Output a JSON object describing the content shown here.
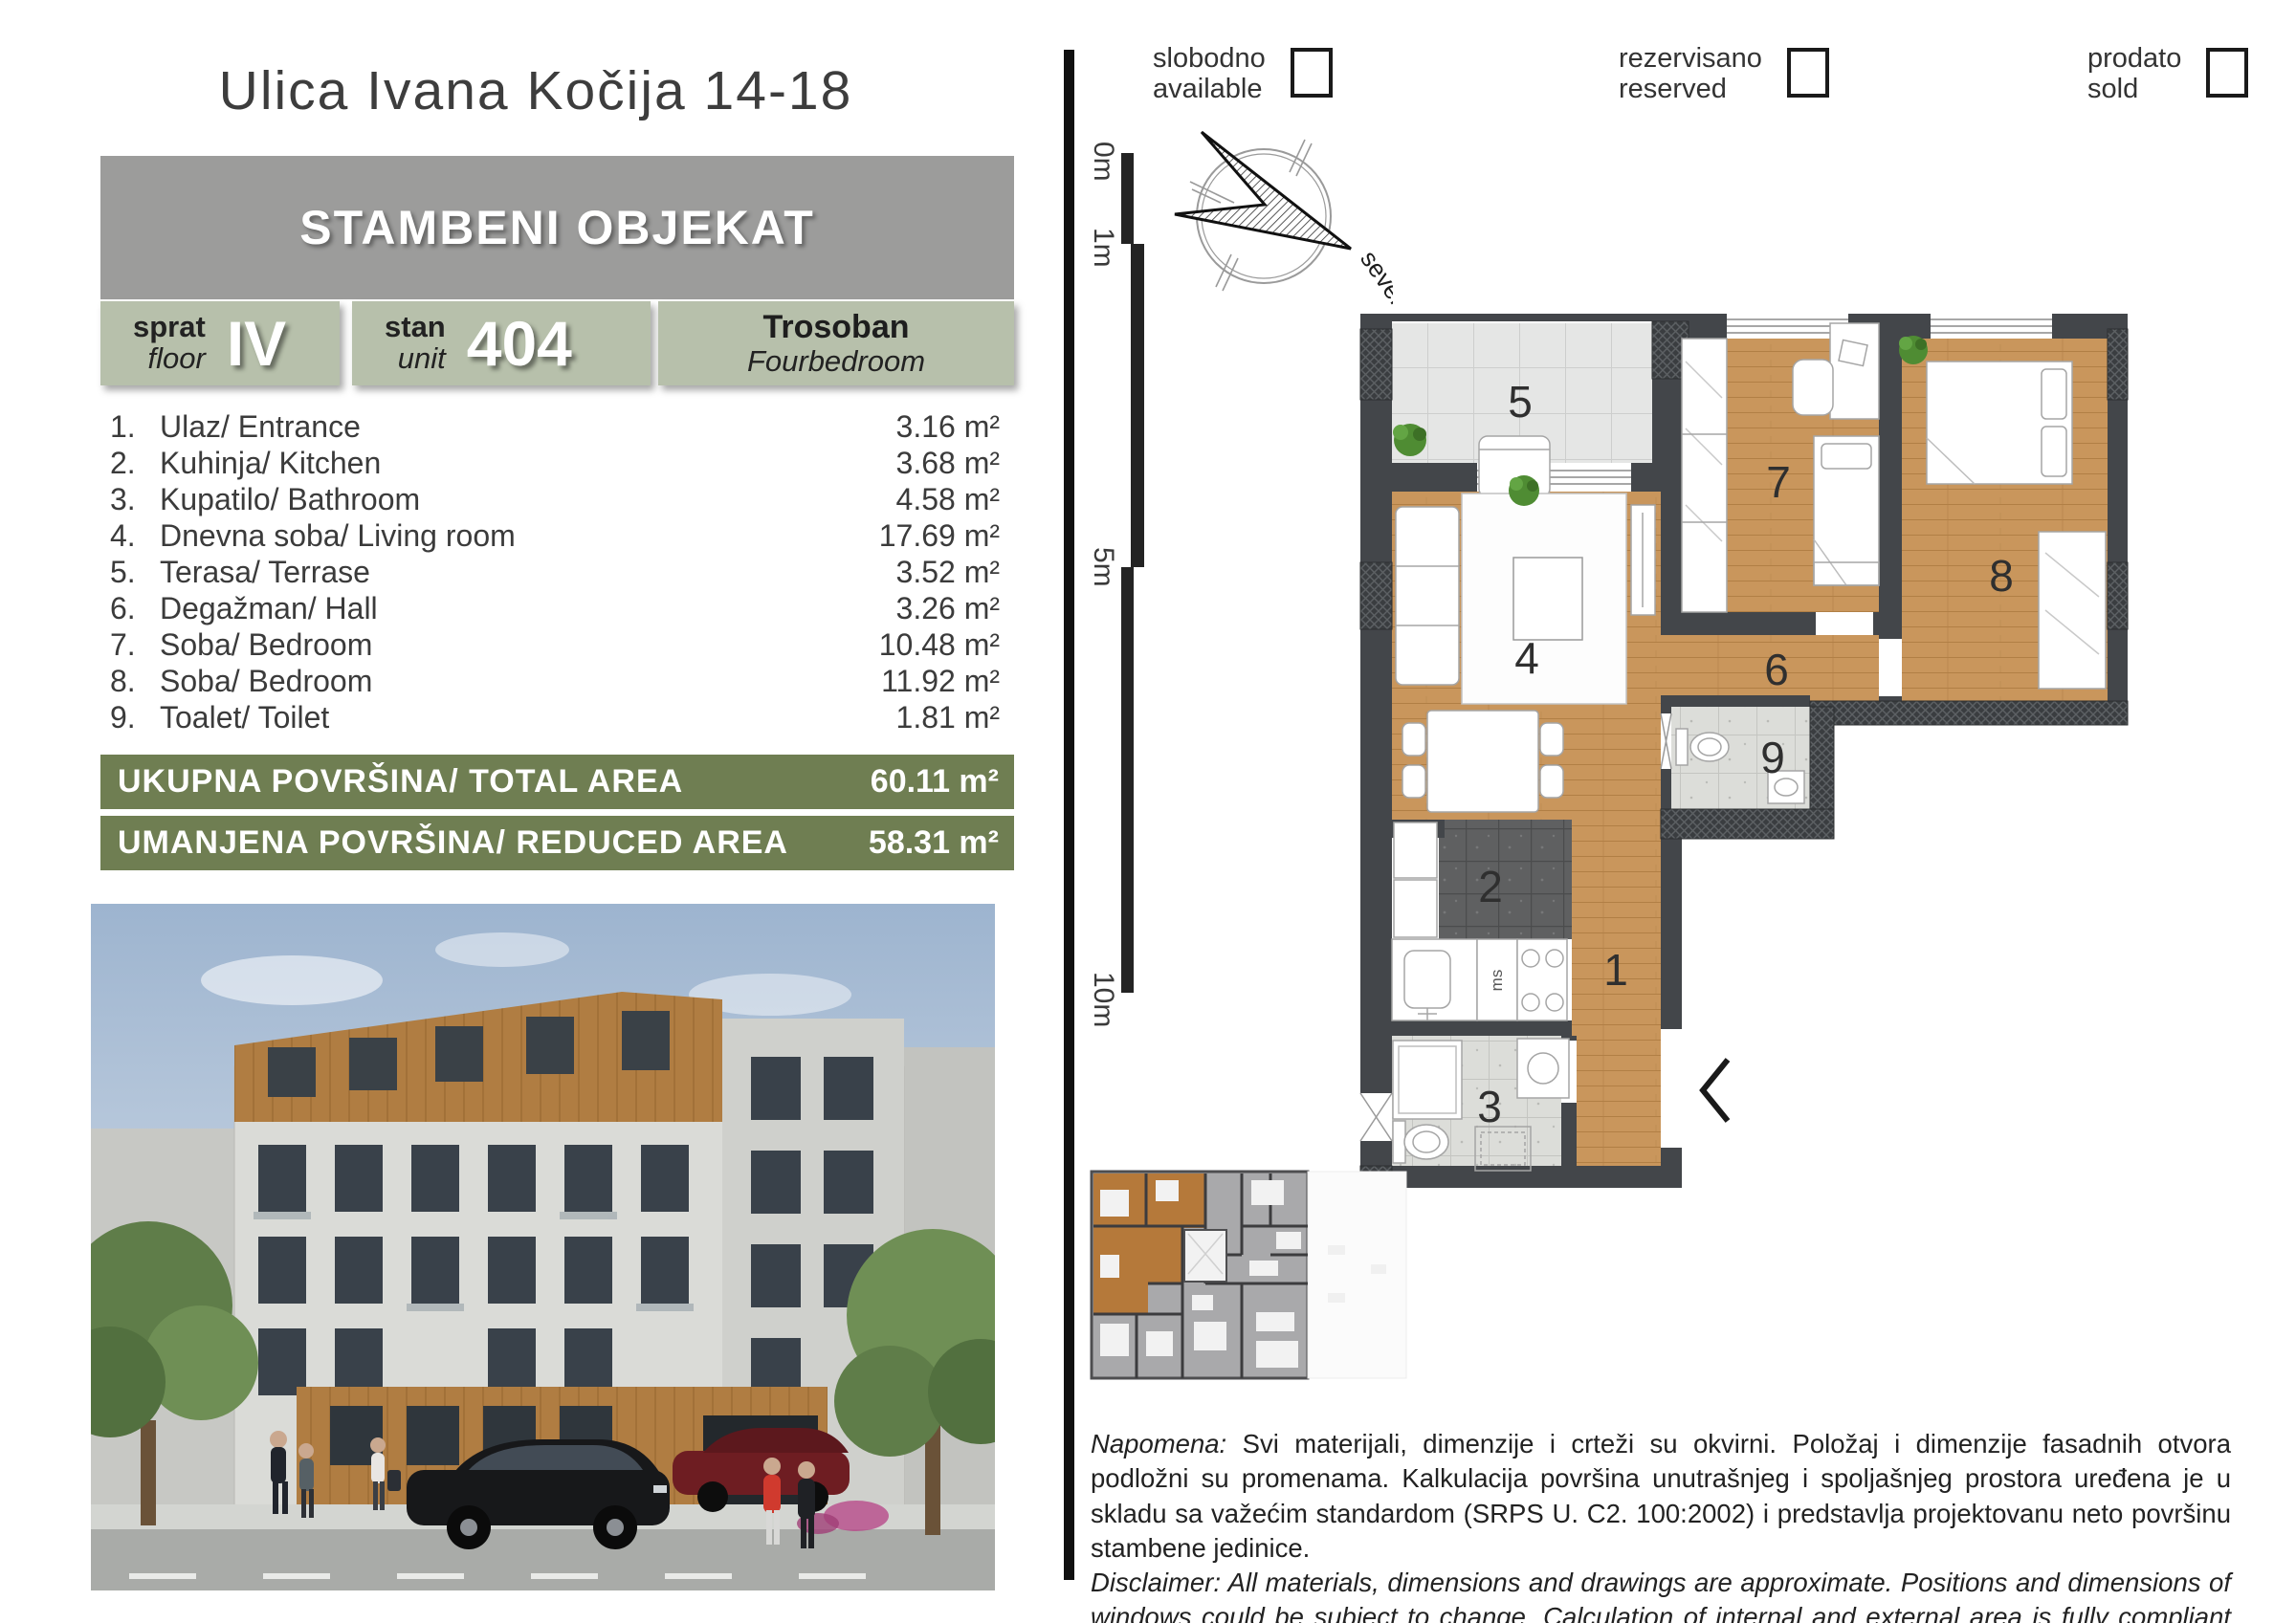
{
  "header": {
    "title": "Ulica Ivana Kočija 14-18",
    "building": "STAMBENI OBJEKAT"
  },
  "info": {
    "floor_label_sr": "sprat",
    "floor_label_en": "floor",
    "floor_value": "IV",
    "unit_label_sr": "stan",
    "unit_label_en": "unit",
    "unit_value": "404",
    "type_sr": "Trosoban",
    "type_en": "Fourbedroom"
  },
  "rooms": [
    {
      "num": "1.",
      "name": "Ulaz/ Entrance",
      "area": "3.16 m²"
    },
    {
      "num": "2.",
      "name": "Kuhinja/ Kitchen",
      "area": "3.68 m²"
    },
    {
      "num": "3.",
      "name": "Kupatilo/ Bathroom",
      "area": "4.58 m²"
    },
    {
      "num": "4.",
      "name": "Dnevna soba/ Living room",
      "area": "17.69 m²"
    },
    {
      "num": "5.",
      "name": "Terasa/ Terrase",
      "area": "3.52 m²"
    },
    {
      "num": "6.",
      "name": "Degažman/ Hall",
      "area": "3.26 m²"
    },
    {
      "num": "7.",
      "name": "Soba/ Bedroom",
      "area": "10.48 m²"
    },
    {
      "num": "8.",
      "name": "Soba/ Bedroom",
      "area": "11.92 m²"
    },
    {
      "num": "9.",
      "name": "Toalet/ Toilet",
      "area": "1.81 m²"
    }
  ],
  "totals": {
    "total_label": "UKUPNA POVRŠINA/ TOTAL AREA",
    "total_value": "60.11 m²",
    "reduced_label": "UMANJENA POVRŠINA/ REDUCED AREA",
    "reduced_value": "58.31 m²"
  },
  "legend": [
    {
      "sr": "slobodno",
      "en": "available"
    },
    {
      "sr": "rezervisano",
      "en": "reserved"
    },
    {
      "sr": "prodato",
      "en": "sold"
    }
  ],
  "scale": {
    "labels": [
      "0m",
      "1m",
      "5m",
      "10m"
    ]
  },
  "compass": {
    "label": "sever"
  },
  "plan": {
    "room_numbers": [
      "1",
      "2",
      "3",
      "4",
      "5",
      "6",
      "7",
      "8",
      "9"
    ],
    "kitchen_unit_label": "ms"
  },
  "notes": {
    "napomena_label": "Napomena:",
    "napomena_text": " Svi materijali, dimenzije i crteži su okvirni. Položaj i dimenzije fasadnih otvora podložni su promenama. Kalkulacija površina unutrašnjeg i spoljašnjeg prostora uređena je u skladu sa važećim standardom (SRPS U. C2. 100:2002) i predstavlja projektovanu neto površinu stambene jedinice.",
    "disclaimer_label": "Disclaimer:",
    "disclaimer_text": " All materials, dimensions and drawings are approximate. Positions and dimensions of windows could be subject to change. Calculation of internal and external area is fully compliant with local standards (SRPS U. C2.100:2002) and as such it represents the net area of the unit."
  },
  "colors": {
    "sage": "#b7c0ab",
    "olive": "#6f7e52",
    "gray_bar": "#9c9c9b",
    "wall": "#43464a",
    "wood": "#c9965c",
    "unit_highlight": "#b5793a"
  }
}
